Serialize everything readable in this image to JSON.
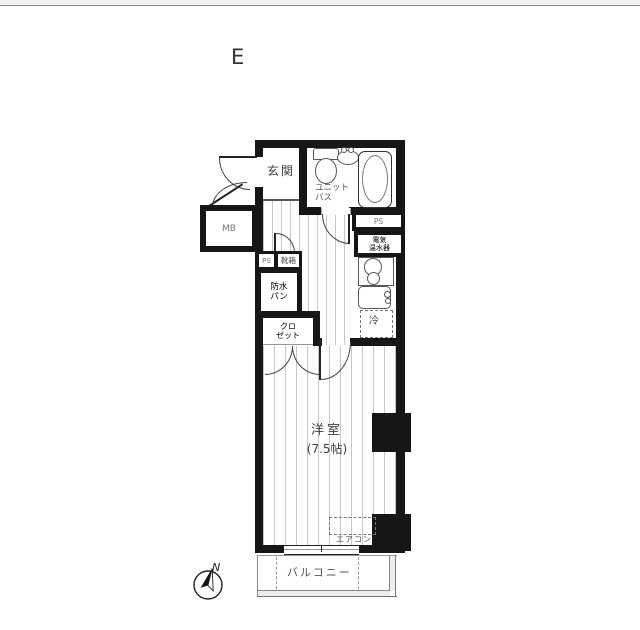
{
  "page": {
    "plan_letter": "E"
  },
  "labels": {
    "genkan": "玄関",
    "unit_bath": [
      "ユニット",
      "バス"
    ],
    "mb": "MB",
    "ps": "PS",
    "water_heater": [
      "電気",
      "温水器"
    ],
    "shoe_box": "靴箱",
    "waterproof_pan": [
      "防水",
      "パン"
    ],
    "closet": [
      "クロ",
      "ゼット"
    ],
    "fridge": "冷",
    "main_room": "洋室",
    "main_room_size": "(7.5帖)",
    "aircon": "エアコン",
    "balcony": "バルコニー"
  },
  "compass": {
    "north": "N"
  },
  "colors": {
    "wall": "#161616",
    "fixture_line": "#555555",
    "floor_line": "#c6c6c6",
    "text": "#4c4c4c"
  }
}
